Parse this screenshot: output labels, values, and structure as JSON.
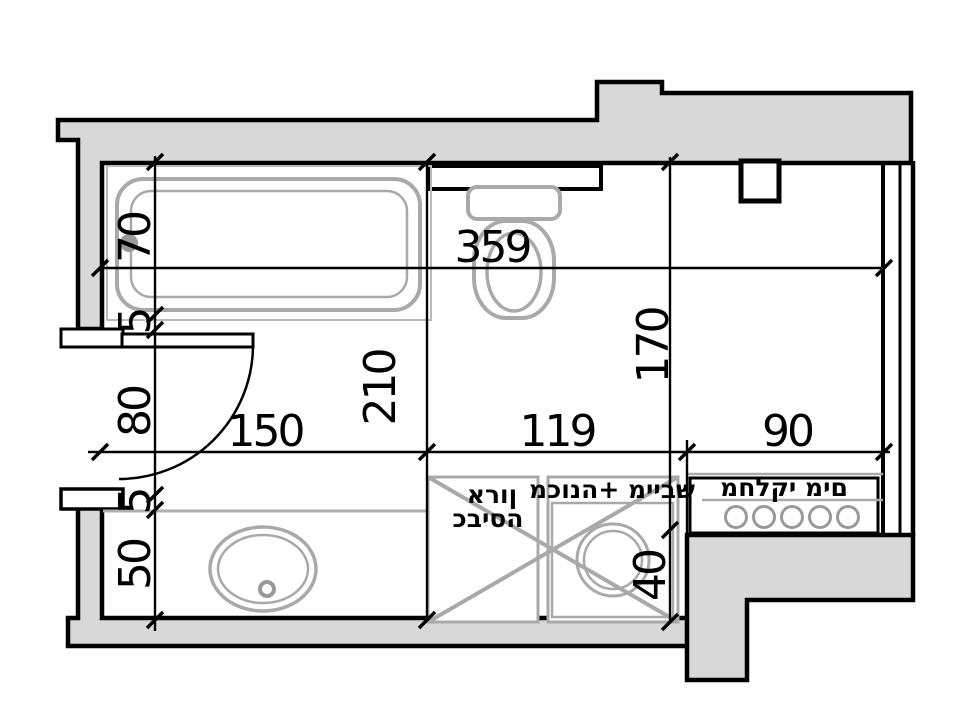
{
  "dimensions": {
    "left_chain": [
      "70",
      "5",
      "80",
      "5",
      "50"
    ],
    "top_width": "359",
    "interior_height": "210",
    "bottom_chain": [
      "150",
      "119",
      "90"
    ],
    "right_height": "170",
    "washer_depth": "40"
  },
  "labels": {
    "laundry_cabinet": {
      "line1": "ארון",
      "line2": "כביסה"
    },
    "washer_dryer": "מכונה+ מייבש",
    "water_manifold": "מחלקי מים"
  },
  "colors": {
    "wall_fill": "#d8d8d8",
    "outline": "#000000",
    "fixture_stroke": "#a9a9a9",
    "background": "#ffffff"
  }
}
